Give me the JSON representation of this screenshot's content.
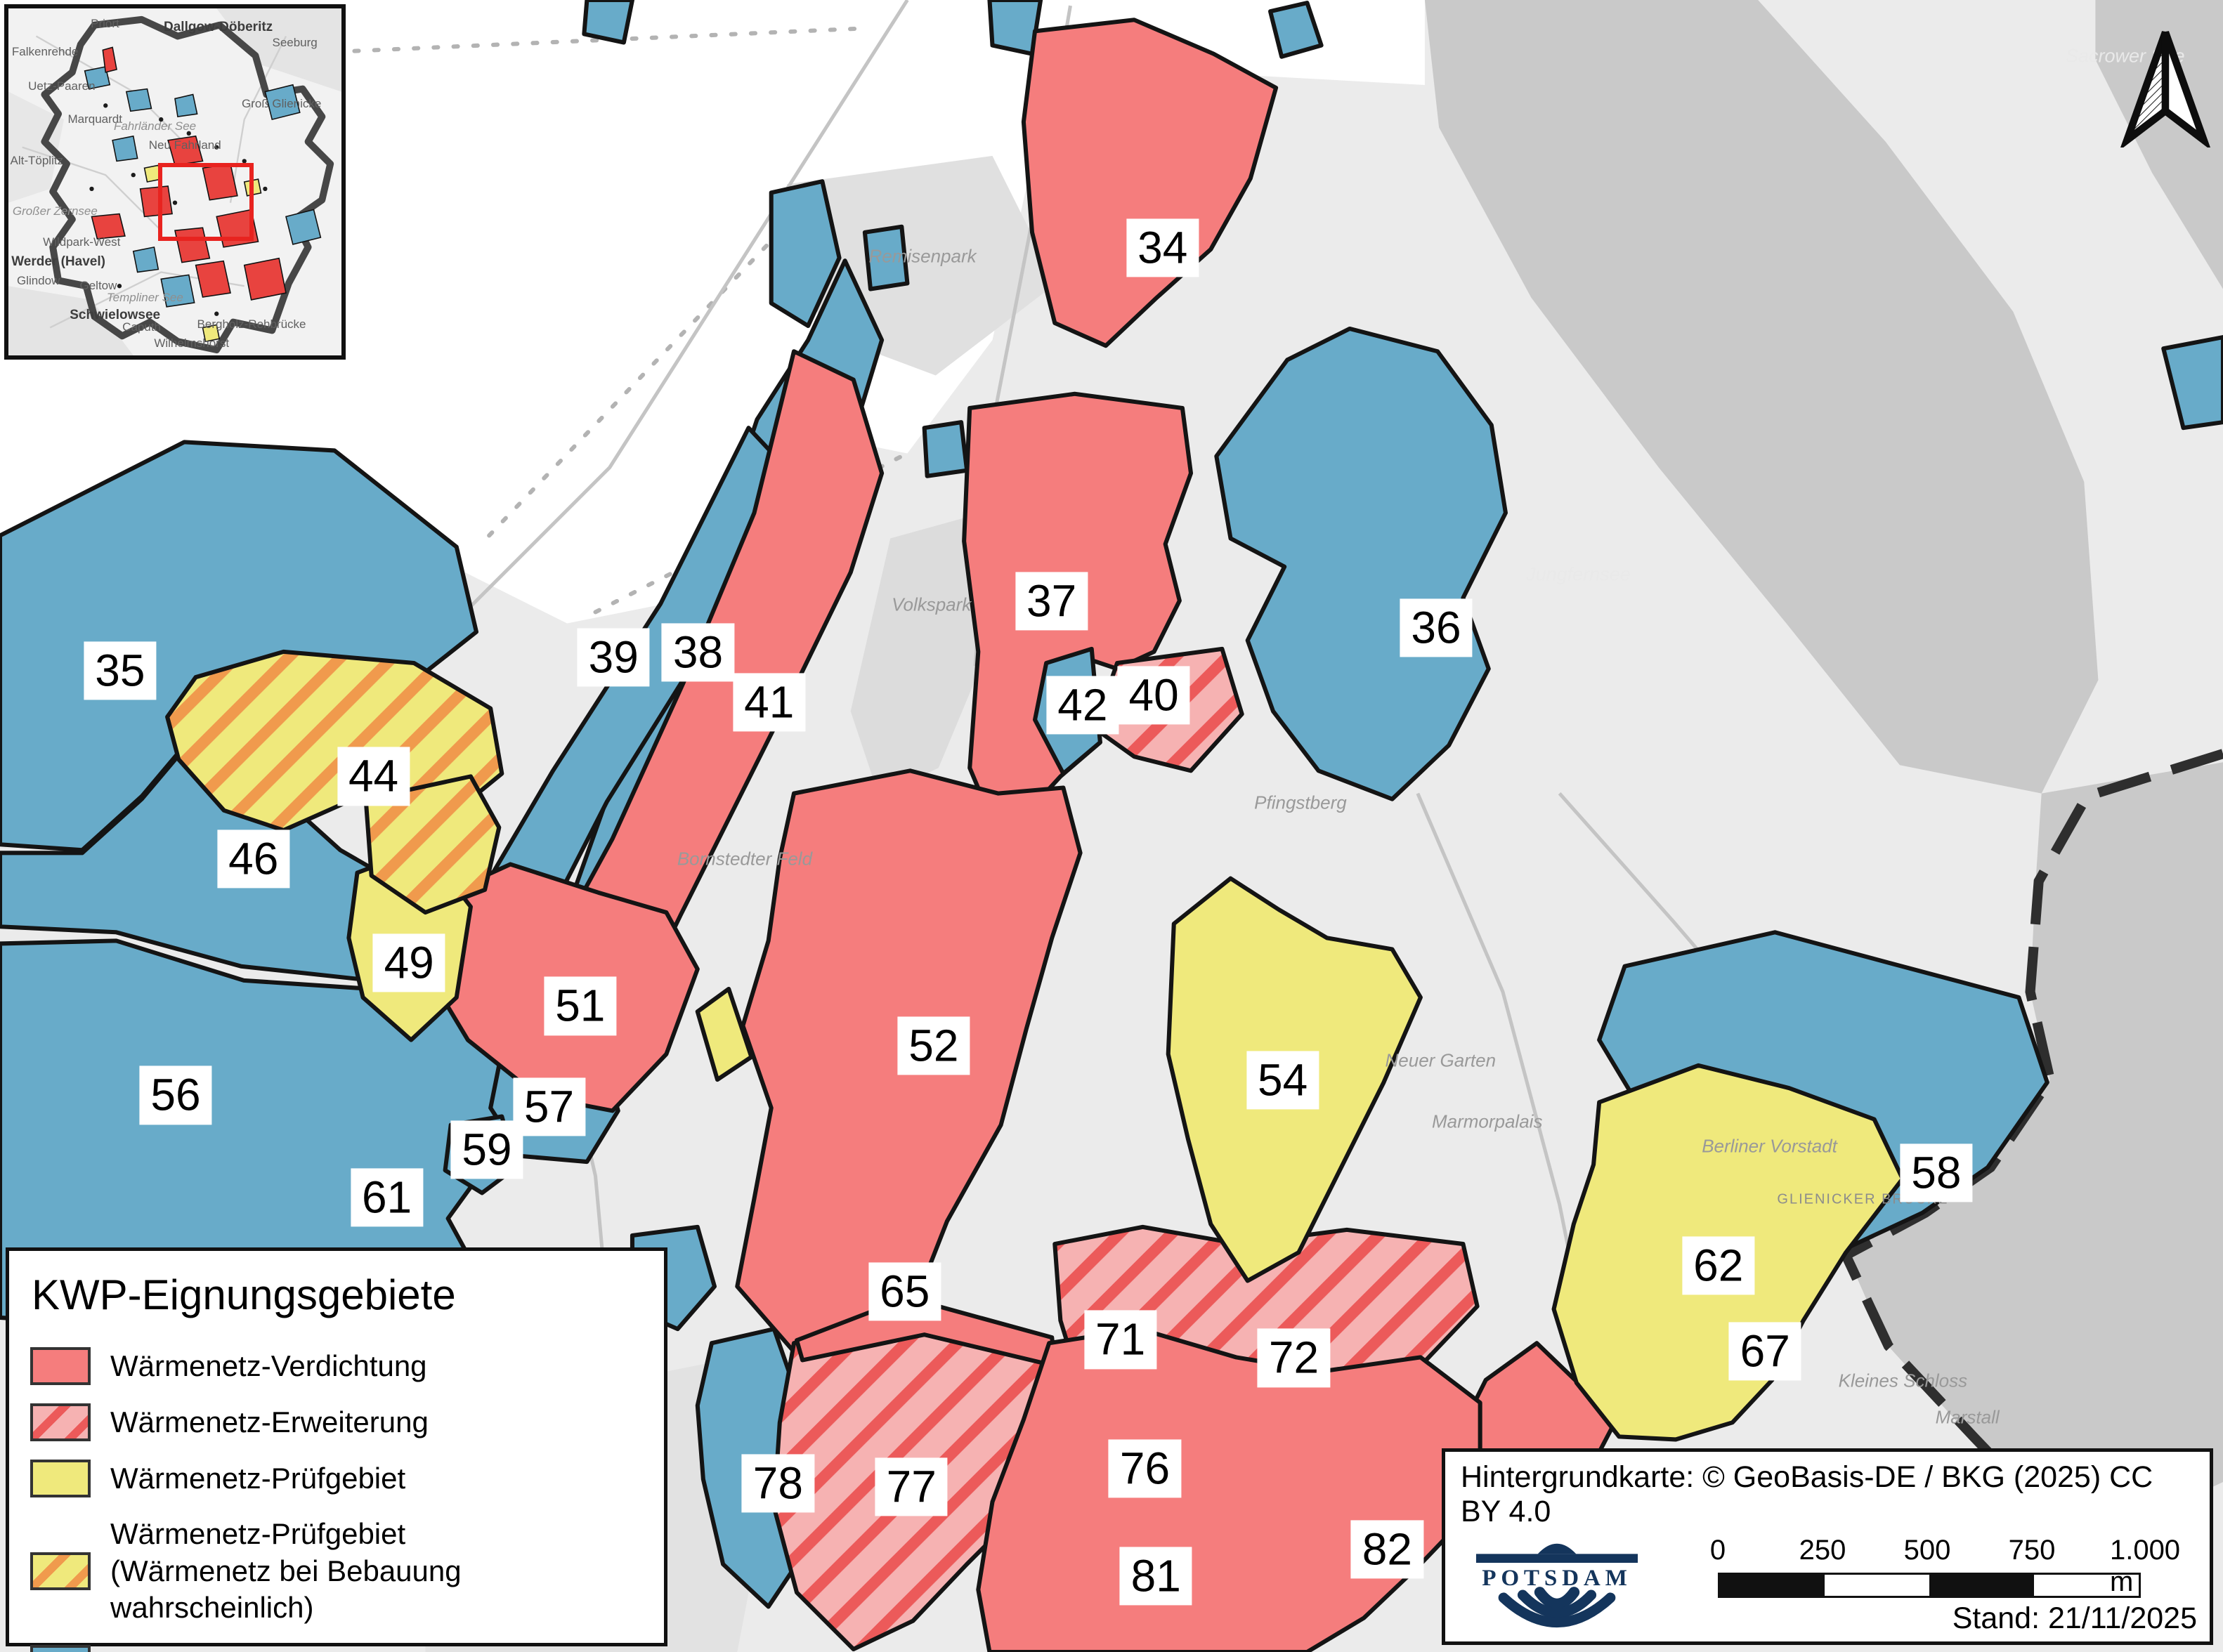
{
  "map": {
    "regions": [
      {
        "n": "34",
        "x": 52.3,
        "y": 15.0
      },
      {
        "n": "35",
        "x": 5.4,
        "y": 40.6
      },
      {
        "n": "36",
        "x": 64.6,
        "y": 38.0
      },
      {
        "n": "37",
        "x": 47.3,
        "y": 36.4
      },
      {
        "n": "38",
        "x": 31.4,
        "y": 39.5
      },
      {
        "n": "39",
        "x": 27.6,
        "y": 39.8
      },
      {
        "n": "40",
        "x": 51.9,
        "y": 42.1
      },
      {
        "n": "41",
        "x": 34.6,
        "y": 42.5
      },
      {
        "n": "42",
        "x": 48.7,
        "y": 42.7
      },
      {
        "n": "44",
        "x": 16.8,
        "y": 47.0
      },
      {
        "n": "46",
        "x": 11.4,
        "y": 52.0
      },
      {
        "n": "49",
        "x": 18.4,
        "y": 58.3
      },
      {
        "n": "51",
        "x": 26.1,
        "y": 60.9
      },
      {
        "n": "52",
        "x": 42.0,
        "y": 63.3
      },
      {
        "n": "54",
        "x": 57.7,
        "y": 65.4
      },
      {
        "n": "56",
        "x": 7.9,
        "y": 66.3
      },
      {
        "n": "57",
        "x": 24.7,
        "y": 67.0
      },
      {
        "n": "58",
        "x": 87.1,
        "y": 71.0
      },
      {
        "n": "59",
        "x": 21.9,
        "y": 69.6
      },
      {
        "n": "61",
        "x": 17.4,
        "y": 72.5
      },
      {
        "n": "62",
        "x": 77.3,
        "y": 76.6
      },
      {
        "n": "65",
        "x": 40.7,
        "y": 78.2
      },
      {
        "n": "67",
        "x": 79.4,
        "y": 81.8
      },
      {
        "n": "71",
        "x": 50.4,
        "y": 81.1
      },
      {
        "n": "72",
        "x": 58.2,
        "y": 82.2
      },
      {
        "n": "76",
        "x": 51.5,
        "y": 88.9
      },
      {
        "n": "77",
        "x": 41.0,
        "y": 90.0
      },
      {
        "n": "78",
        "x": 35.0,
        "y": 89.8
      },
      {
        "n": "81",
        "x": 52.0,
        "y": 95.4
      },
      {
        "n": "82",
        "x": 62.4,
        "y": 93.8
      }
    ],
    "labels": [
      {
        "text": "Jungfernsee",
        "x": 71.0,
        "y": 34.8,
        "kind": "water"
      },
      {
        "text": "Sacrower See",
        "x": 95.6,
        "y": 3.4,
        "kind": "water"
      },
      {
        "text": "Neuer Garten",
        "x": 64.8,
        "y": 64.2,
        "kind": "land"
      },
      {
        "text": "Marmorpalais",
        "x": 66.9,
        "y": 67.9,
        "kind": "land"
      },
      {
        "text": "Berliner Vorstadt",
        "x": 79.6,
        "y": 69.4,
        "kind": "land"
      },
      {
        "text": "Remisenpark",
        "x": 41.5,
        "y": 15.5,
        "kind": "land"
      },
      {
        "text": "Volkspark",
        "x": 41.9,
        "y": 36.6,
        "kind": "land"
      },
      {
        "text": "Pfingstberg",
        "x": 58.5,
        "y": 48.6,
        "kind": "land"
      },
      {
        "text": "Bornstedter Feld",
        "x": 33.5,
        "y": 52.0,
        "kind": "land"
      },
      {
        "text": "GLIENICKER BRÜCKE",
        "x": 83.8,
        "y": 72.6,
        "kind": "caps"
      },
      {
        "text": "Kleines Schloss",
        "x": 85.6,
        "y": 83.6,
        "kind": "land"
      },
      {
        "text": "Marstall",
        "x": 88.5,
        "y": 85.8,
        "kind": "land"
      }
    ]
  },
  "legend": {
    "title": "KWP-Eignungsgebiete",
    "items": [
      {
        "label": "Wärmenetz-Verdichtung",
        "swatch": "solid-red"
      },
      {
        "label": "Wärmenetz-Erweiterung",
        "swatch": "hatch-red"
      },
      {
        "label": "Wärmenetz-Prüfgebiet",
        "swatch": "solid-yellow"
      },
      {
        "label": "Wärmenetz-Prüfgebiet",
        "label2": "(Wärmenetz bei Bebauung wahrscheinlich)",
        "swatch": "hatch-yellow"
      },
      {
        "label": "Individualversorgung",
        "swatch": "solid-blue"
      }
    ]
  },
  "attribution": {
    "text": "Hintergrundkarte: © GeoBasis-DE / BKG (2025) CC BY 4.0",
    "logo_text": "POTSDAM",
    "stand": "Stand: 21/11/2025",
    "scalebar": {
      "ticks": [
        "0",
        "250",
        "500",
        "750",
        "1.000 m"
      ]
    }
  },
  "inset": {
    "labels": [
      {
        "text": "Dallgow-Döberitz",
        "x": 63,
        "y": 5.5,
        "bold": true
      },
      {
        "text": "Seeburg",
        "x": 86,
        "y": 10
      },
      {
        "text": "Priort",
        "x": 29,
        "y": 4.5
      },
      {
        "text": "Falkenrehde",
        "x": 11,
        "y": 12.5
      },
      {
        "text": "Uetz-Paaren",
        "x": 16,
        "y": 22.5
      },
      {
        "text": "Marquardt",
        "x": 26,
        "y": 32
      },
      {
        "text": "Fahrländer See",
        "x": 44,
        "y": 34,
        "italic": true
      },
      {
        "text": "Neu Fahrland",
        "x": 53,
        "y": 39.5
      },
      {
        "text": "Groß Glienicke",
        "x": 82,
        "y": 27.5
      },
      {
        "text": "Alt-Töplitz",
        "x": 8.5,
        "y": 44
      },
      {
        "text": "Großer Zernsee",
        "x": 14,
        "y": 58.5,
        "italic": true
      },
      {
        "text": "Wildpark-West",
        "x": 22,
        "y": 67.5
      },
      {
        "text": "Werder (Havel)",
        "x": 15,
        "y": 73,
        "bold": true
      },
      {
        "text": "Glindow",
        "x": 9,
        "y": 78.5
      },
      {
        "text": "Geltow",
        "x": 27,
        "y": 80
      },
      {
        "text": "Templiner See",
        "x": 41,
        "y": 83.5,
        "italic": true
      },
      {
        "text": "Schwielowsee",
        "x": 32,
        "y": 88.5,
        "bold": true
      },
      {
        "text": "Caputh",
        "x": 40,
        "y": 92
      },
      {
        "text": "Bergholz-Rehbrücke",
        "x": 73,
        "y": 91
      },
      {
        "text": "Wilhelmshorst",
        "x": 55,
        "y": 96.5
      }
    ]
  },
  "colors": {
    "zone_red": "#f57d7d",
    "zone_red_stripe": "#ec5a5a",
    "zone_red_hatch_bg": "#f6b2b2",
    "zone_yellow": "#efe97c",
    "zone_yellow_stripe": "#f09a4d",
    "zone_blue": "#68abc9",
    "water": "#c9c9c9",
    "background": "#ebebeb",
    "view_rect_red": "#e8231f",
    "logo_navy": "#14355c"
  }
}
